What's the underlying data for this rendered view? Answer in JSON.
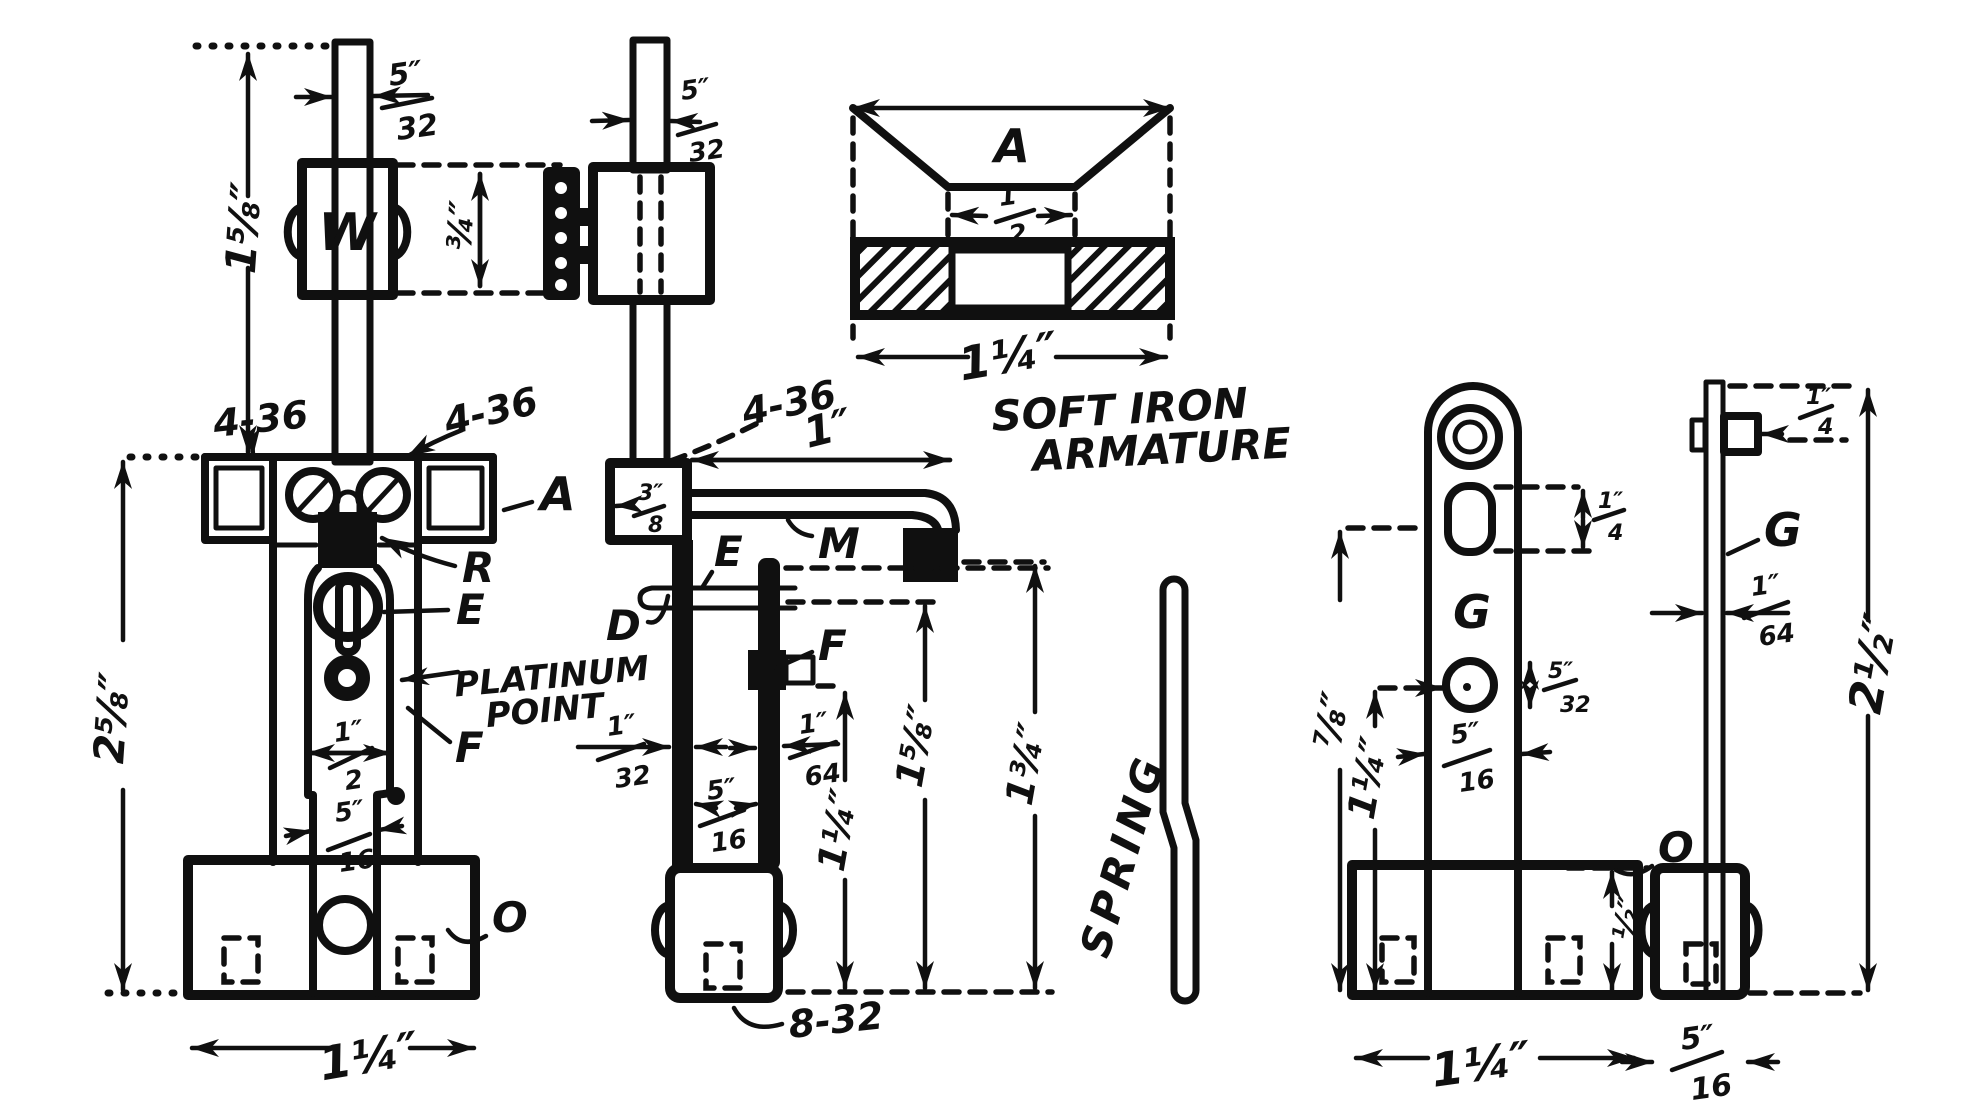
{
  "palette": {
    "ink": "#101010",
    "paper": "#ffffff"
  },
  "ann": {
    "platinum1": "PLATINUM",
    "platinum2": "POINT",
    "soft1": "SOFT IRON",
    "soft2": "ARMATURE",
    "spring": "SPRING",
    "t436a": "4-36",
    "t436b": "4-36",
    "t436c": "4-36",
    "t832": "8-32"
  },
  "lbl": {
    "w": "W",
    "a": "A",
    "a_armature": "A",
    "r": "R",
    "e": "E",
    "e2": "E",
    "f": "F",
    "f2": "F",
    "d": "D",
    "m": "M",
    "o": "O",
    "o2": "O",
    "g": "G",
    "g2": "G"
  },
  "dims": {
    "f1_rod": {
      "num": "5″",
      "den": "32"
    },
    "f1_rod_to_bracket": "1⅝″",
    "f1_weight_height": "¾″",
    "f1_overall": "2⅝″",
    "f1_spring_wide": {
      "num": "1″",
      "den": "2"
    },
    "f1_spring_narrow": {
      "num": "5″",
      "den": "16"
    },
    "f1_base_width": "1¼″",
    "f2_rod": {
      "num": "5″",
      "den": "32"
    },
    "f2_block": {
      "num": "3″",
      "den": "8"
    },
    "f2_arm": "1″",
    "f2_plate": {
      "num": "1″",
      "den": "32"
    },
    "f2_gap": {
      "num": "5″",
      "den": "16"
    },
    "f2_spring_thick": {
      "num": "1″",
      "den": "64"
    },
    "f2_tip_to_base": "1¼″",
    "f2_screw_to_base": "1⅝″",
    "f2_arm_to_base": "1¾″",
    "f3_slot": {
      "num": "1″",
      "den": "2"
    },
    "f3_width": "1¼″",
    "f4_slot": {
      "num": "1″",
      "den": "4"
    },
    "f4_hole": {
      "num": "5″",
      "den": "32"
    },
    "f4_width": {
      "num": "5″",
      "den": "16"
    },
    "f4_slot_to_base": "⅞″",
    "f4_hole_to_base": "1¼″",
    "f4_base_height": "½″",
    "f4_base_width": "1¼″",
    "f5_clip": {
      "num": "1″",
      "den": "4"
    },
    "f5_thick": {
      "num": "1″",
      "den": "64"
    },
    "f5_height": "2½″",
    "f5_base": {
      "num": "5″",
      "den": "16"
    }
  }
}
